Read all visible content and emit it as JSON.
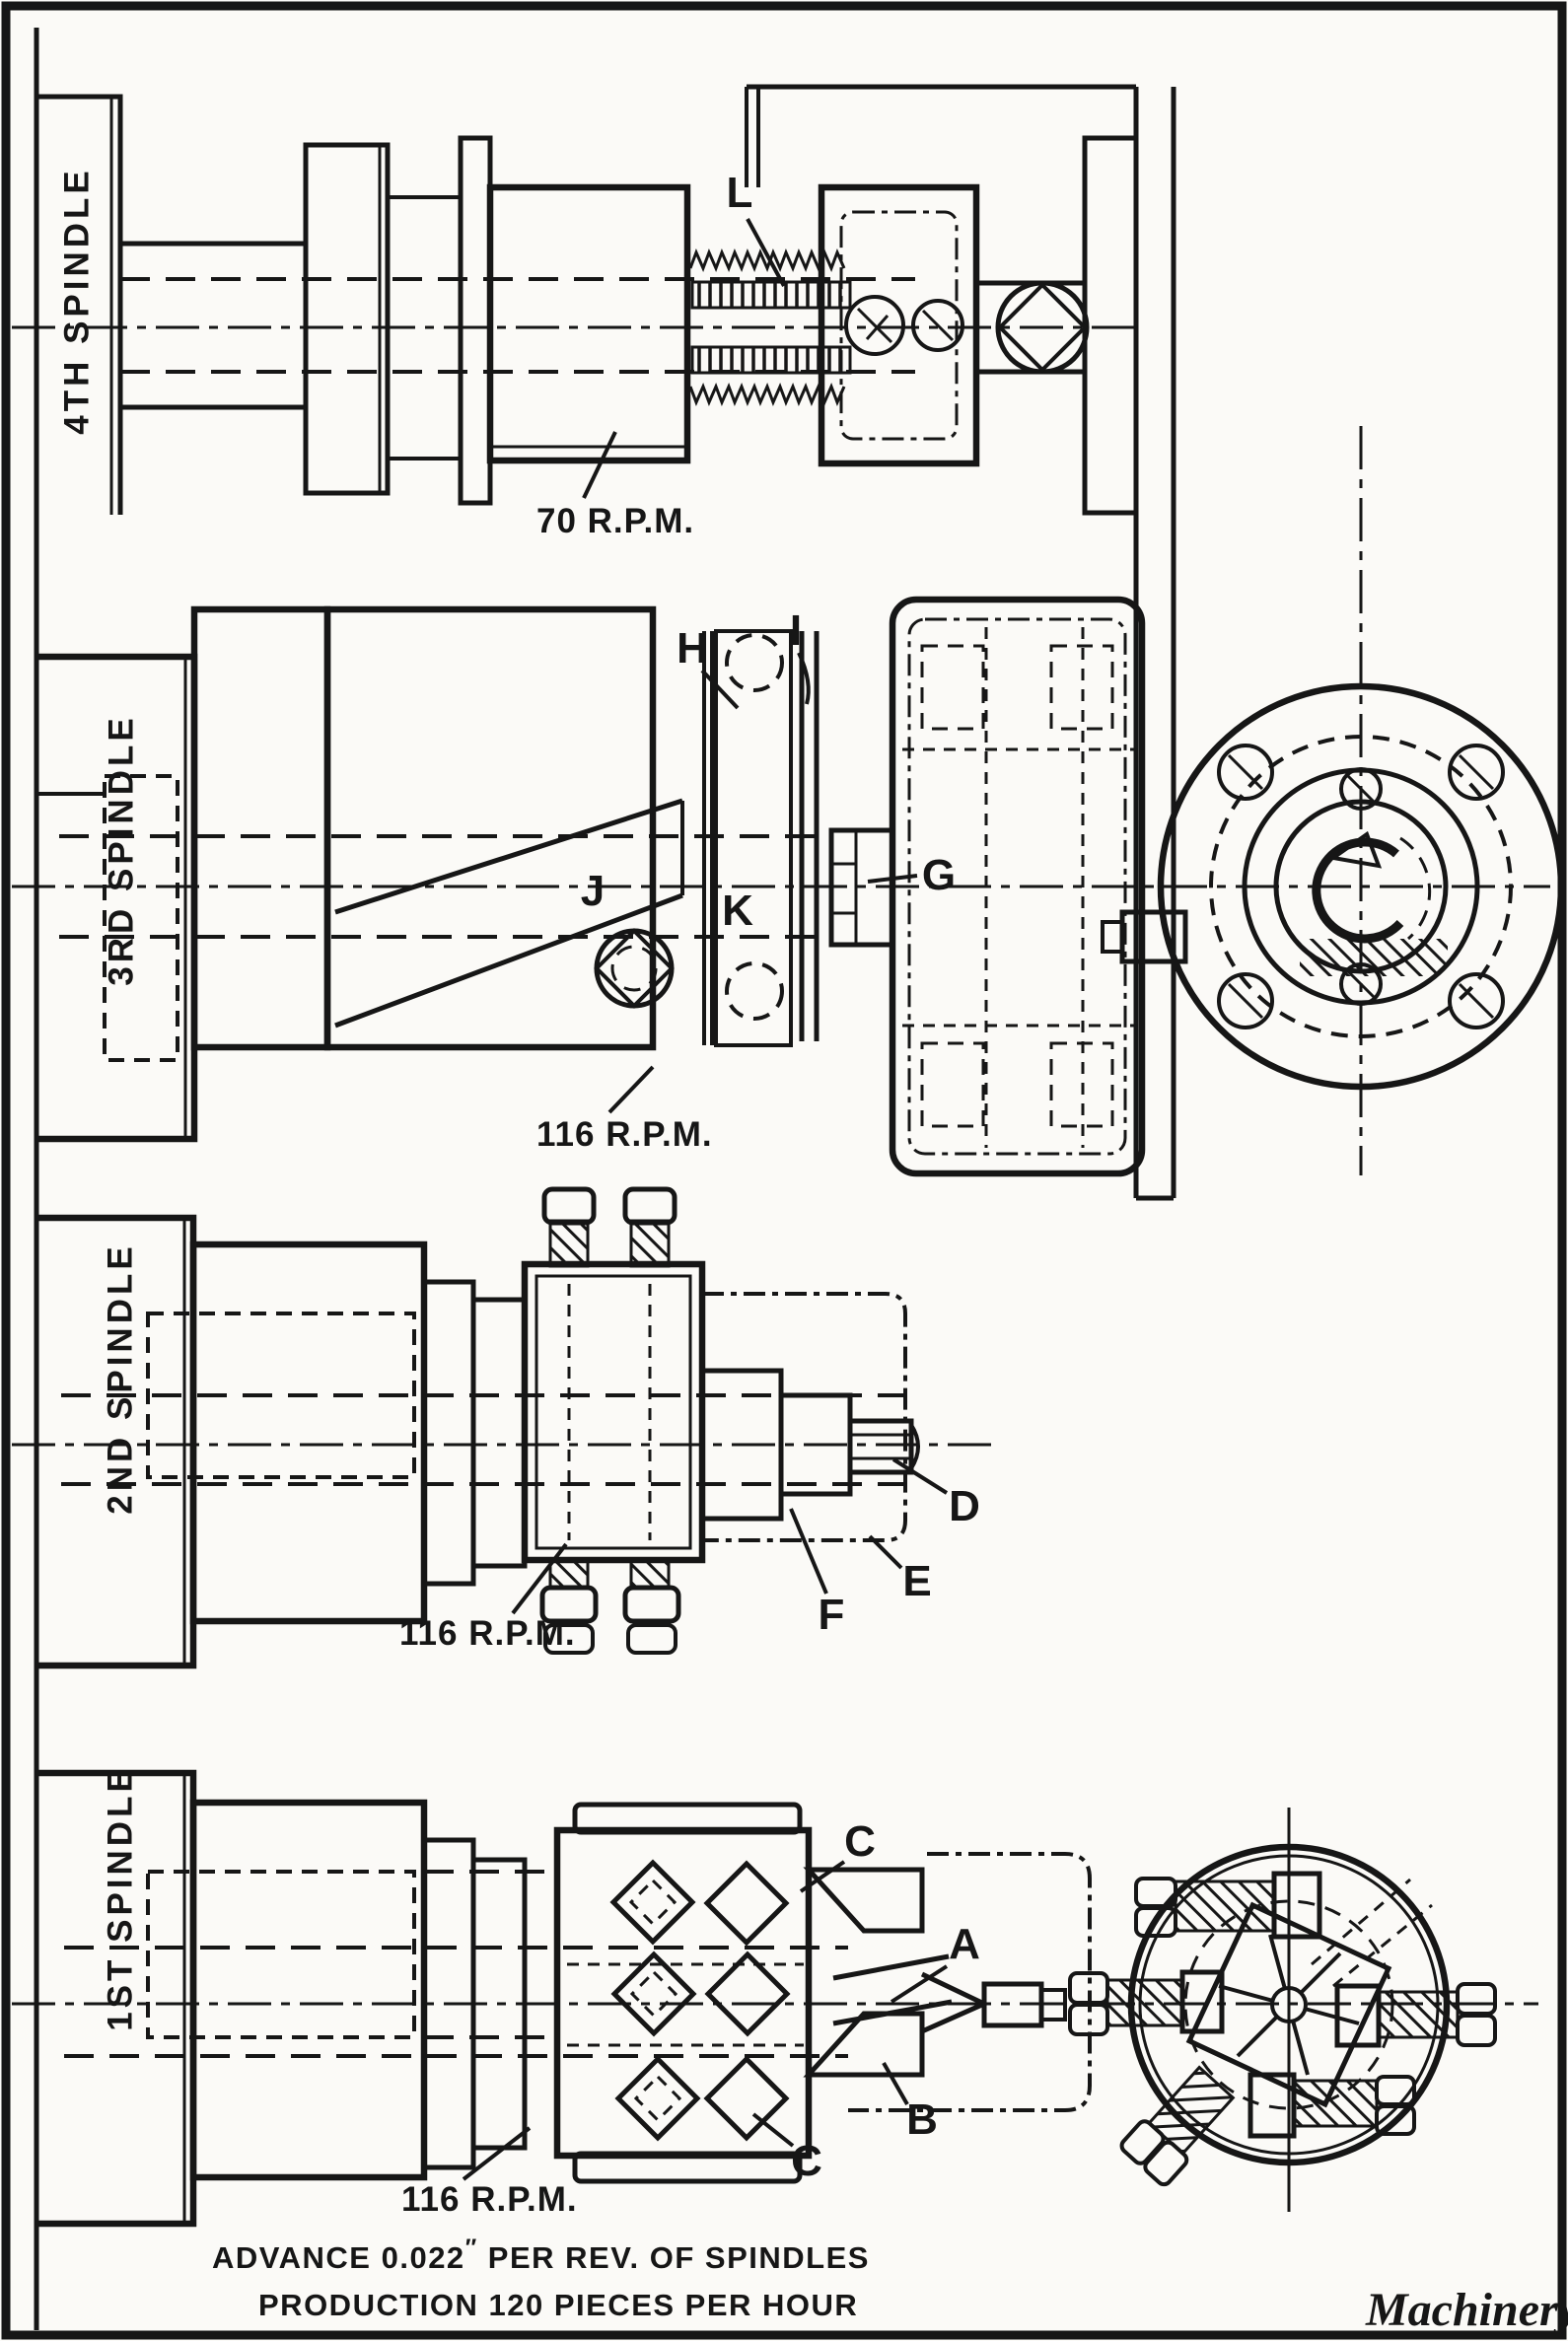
{
  "drawing": {
    "paper_color": "#fbfaf7",
    "ink_color": "#161616"
  },
  "sections": [
    {
      "name": "4th-spindle",
      "label": "4TH SPINDLE",
      "rpm": "70 R.P.M."
    },
    {
      "name": "3rd-spindle",
      "label": "3RD SPINDLE",
      "rpm": "116 R.P.M."
    },
    {
      "name": "2nd-spindle",
      "label": "2ND SPINDLE",
      "rpm": "116 R.P.M."
    },
    {
      "name": "1st-spindle",
      "label": "1ST SPINDLE",
      "rpm": "116 R.P.M."
    }
  ],
  "callouts": {
    "a": "A",
    "b": "B",
    "c_upper": "C",
    "c_lower": "C",
    "d": "D",
    "e": "E",
    "f": "F",
    "g": "G",
    "h": "H",
    "i": "I",
    "j": "J",
    "k": "K",
    "l": "L"
  },
  "notes": {
    "advance_prefix": "ADVANCE 0.022",
    "inch_mark": "″",
    "advance_suffix": " PER REV. OF SPINDLES",
    "production": "PRODUCTION 120 PIECES PER HOUR"
  },
  "credit": "Machinery"
}
